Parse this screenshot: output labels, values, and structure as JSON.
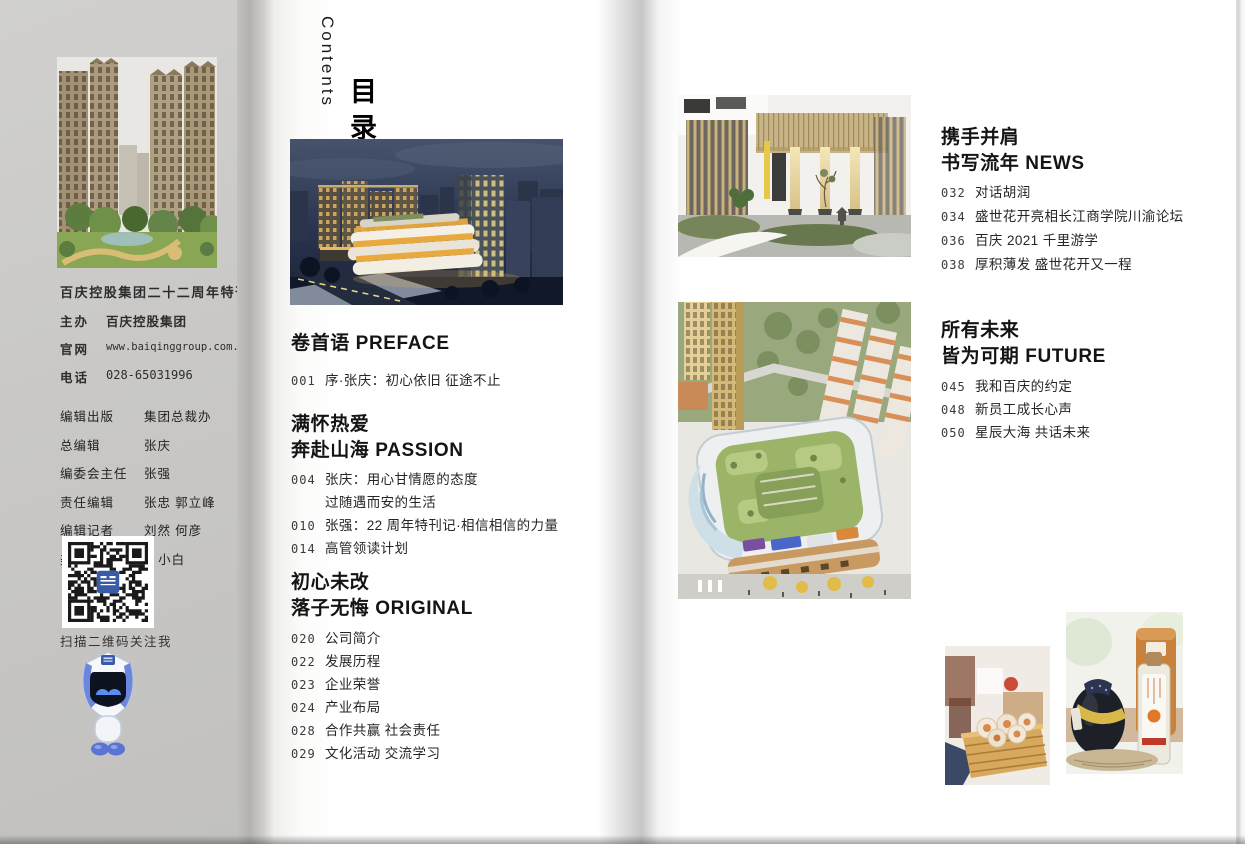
{
  "colors": {
    "accent_blue": "#3a5ba8",
    "qr_logo_blue": "#3a5ba8"
  },
  "sidebar": {
    "publication": {
      "title": "百庆控股集团二十二周年特刊",
      "rows": [
        {
          "label": "主办",
          "value": "百庆控股集团"
        },
        {
          "label": "官网",
          "value": "www.baiqinggroup.com.cn"
        },
        {
          "label": "电话",
          "value": "028-65031996"
        }
      ]
    },
    "credits": [
      {
        "label": "编辑出版",
        "value": "集团总裁办"
      },
      {
        "label": "总编辑",
        "value": "张庆"
      },
      {
        "label": "编委会主任",
        "value": "张强"
      },
      {
        "label": "责任编辑",
        "value": "张忠 郭立峰"
      },
      {
        "label": "编辑记者",
        "value": "刘然 何彦"
      },
      {
        "label": "美术编辑",
        "value": "Q 小白"
      }
    ],
    "qr_caption": "扫描二维码关注我"
  },
  "toc": {
    "title_en": "Contents",
    "title_zh": "目录",
    "left_sections": [
      {
        "heading": [
          "卷首语 PREFACE"
        ],
        "items": [
          {
            "num": "001",
            "text": "序·张庆：初心依旧 征途不止"
          }
        ]
      },
      {
        "heading": [
          "满怀热爱",
          "奔赴山海 PASSION"
        ],
        "items": [
          {
            "num": "004",
            "text": "张庆：用心甘情愿的态度"
          },
          {
            "num": "",
            "text": "过随遇而安的生活"
          },
          {
            "num": "010",
            "text": "张强：22 周年特刊记·相信相信的力量"
          },
          {
            "num": "014",
            "text": "高管领读计划"
          }
        ]
      },
      {
        "heading": [
          "初心未改",
          "落子无悔 ORIGINAL"
        ],
        "items": [
          {
            "num": "020",
            "text": "公司简介"
          },
          {
            "num": "022",
            "text": "发展历程"
          },
          {
            "num": "023",
            "text": "企业荣誉"
          },
          {
            "num": "024",
            "text": "产业布局"
          },
          {
            "num": "028",
            "text": "合作共赢 社会责任"
          },
          {
            "num": "029",
            "text": "文化活动 交流学习"
          }
        ]
      }
    ],
    "right_sections": [
      {
        "heading": [
          "携手并肩",
          "书写流年 NEWS"
        ],
        "items": [
          {
            "num": "032",
            "text": "对话胡润"
          },
          {
            "num": "034",
            "text": "盛世花开亮相长江商学院川渝论坛"
          },
          {
            "num": "036",
            "text": "百庆 2021 千里游学"
          },
          {
            "num": "038",
            "text": "厚积薄发 盛世花开又一程"
          }
        ]
      },
      {
        "heading": [
          "所有未来",
          "皆为可期 FUTURE"
        ],
        "items": [
          {
            "num": "045",
            "text": "我和百庆的约定"
          },
          {
            "num": "048",
            "text": "新员工成长心声"
          },
          {
            "num": "050",
            "text": "星辰大海 共话未来"
          }
        ]
      }
    ]
  }
}
